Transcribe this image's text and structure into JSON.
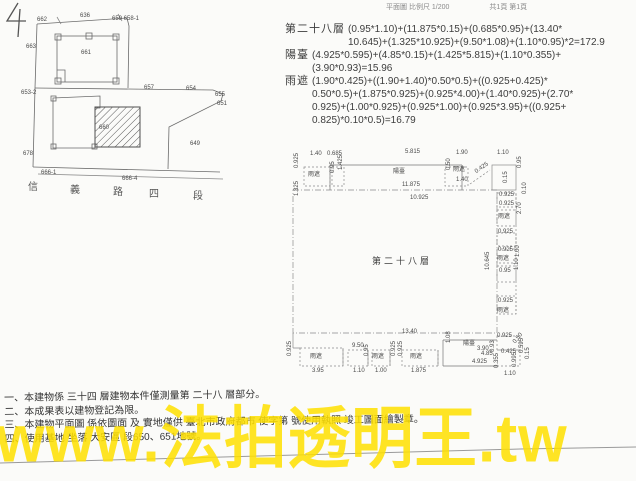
{
  "page": {
    "corner_mark": "4",
    "header": {
      "scale_text": "平面圖 比例尺  1/200",
      "page_text": "共1頁 第1頁"
    }
  },
  "calculations": {
    "entries": [
      {
        "label": "第二十八層",
        "lines": [
          "(0.95*1.10)+(11.875*0.15)+(0.685*0.95)+(13.40*",
          "10.645)+(1.325*10.925)+(9.50*1.08)+(1.10*0.95)*2=172.9"
        ]
      },
      {
        "label": "陽臺",
        "lines": [
          "(4.925*0.595)+(4.85*0.15)+(1.425*5.815)+(1.10*0.355)+",
          "(3.90*0.93)=15.96"
        ]
      },
      {
        "label": "雨遮",
        "lines": [
          "(1.90*0.425)+((1.90+1.40)*0.50*0.5)+((0.925+0.425)*",
          "0.50*0.5)+(1.875*0.925)+(0.925*4.00)+(1.40*0.925)+(2.70*",
          "0.925)+(1.00*0.925)+(0.925*1.00)+(0.925*3.95)+((0.925+",
          "0.825)*0.10*0.5)=16.79"
        ]
      }
    ]
  },
  "site_plan": {
    "hatched_parcel": "660",
    "parcels": [
      {
        "t": "662",
        "x": 37,
        "y": 17
      },
      {
        "t": "636",
        "x": 80,
        "y": 13
      },
      {
        "t": "659 658-1",
        "x": 112,
        "y": 16
      },
      {
        "t": "663",
        "x": 26,
        "y": 44
      },
      {
        "t": "661",
        "x": 81,
        "y": 50
      },
      {
        "t": "653-2",
        "x": 21,
        "y": 90
      },
      {
        "t": "657",
        "x": 144,
        "y": 85
      },
      {
        "t": "654",
        "x": 186,
        "y": 86
      },
      {
        "t": "655",
        "x": 215,
        "y": 92
      },
      {
        "t": "651",
        "x": 217,
        "y": 101
      },
      {
        "t": "660",
        "x": 99,
        "y": 125
      },
      {
        "t": "649",
        "x": 190,
        "y": 141
      },
      {
        "t": "678",
        "x": 23,
        "y": 151
      },
      {
        "t": "666-1",
        "x": 41,
        "y": 170
      },
      {
        "t": "666-4",
        "x": 122,
        "y": 176
      }
    ],
    "street": [
      {
        "t": "信",
        "x": 28,
        "y": 185,
        "cls": "street"
      },
      {
        "t": "義",
        "x": 70,
        "y": 188,
        "cls": "street"
      },
      {
        "t": "路",
        "x": 113,
        "y": 190,
        "cls": "street"
      },
      {
        "t": "四",
        "x": 149,
        "y": 192,
        "cls": "street"
      },
      {
        "t": "段",
        "x": 193,
        "y": 194,
        "cls": "street"
      }
    ]
  },
  "floor_plan": {
    "room_label": "第二十八層",
    "labels": [
      {
        "t": "1.40",
        "x": 310,
        "y": 151
      },
      {
        "t": "0.685",
        "x": 327,
        "y": 151
      },
      {
        "t": "0.925",
        "x": 294,
        "y": 168,
        "rot": -90
      },
      {
        "t": "雨遮",
        "x": 308,
        "y": 172
      },
      {
        "t": "0.95",
        "x": 330,
        "y": 173,
        "rot": -90
      },
      {
        "t": "1.425",
        "x": 338,
        "y": 170,
        "rot": -90
      },
      {
        "t": "1.325",
        "x": 294,
        "y": 196,
        "rot": -90
      },
      {
        "t": "5.815",
        "x": 405,
        "y": 149
      },
      {
        "t": "陽臺",
        "x": 393,
        "y": 169
      },
      {
        "t": "11.875",
        "x": 402,
        "y": 182
      },
      {
        "t": "1.90",
        "x": 456,
        "y": 150
      },
      {
        "t": "0.50",
        "x": 446,
        "y": 170,
        "rot": -90
      },
      {
        "t": "雨遮",
        "x": 453,
        "y": 167
      },
      {
        "t": "1.40",
        "x": 456,
        "y": 177
      },
      {
        "t": "0.425",
        "x": 474,
        "y": 170,
        "rot": -35
      },
      {
        "t": "1.10",
        "x": 497,
        "y": 150
      },
      {
        "t": "0.95",
        "x": 517,
        "y": 168,
        "rot": -90
      },
      {
        "t": "0.15",
        "x": 503,
        "y": 183,
        "rot": -90
      },
      {
        "t": "10.925",
        "x": 410,
        "y": 195
      },
      {
        "t": "0.925",
        "x": 499,
        "y": 192
      },
      {
        "t": "0.10",
        "x": 522,
        "y": 194,
        "rot": -90
      },
      {
        "t": "0.925",
        "x": 499,
        "y": 201
      },
      {
        "t": "雨遮",
        "x": 498,
        "y": 214
      },
      {
        "t": "2.70",
        "x": 517,
        "y": 214,
        "rot": -90
      },
      {
        "t": "0.925",
        "x": 498,
        "y": 229
      },
      {
        "t": "0.925",
        "x": 498,
        "y": 247
      },
      {
        "t": "雨遮",
        "x": 497,
        "y": 256
      },
      {
        "t": "1.00",
        "x": 515,
        "y": 257,
        "rot": -90
      },
      {
        "t": "10.645",
        "x": 485,
        "y": 270,
        "rot": -90
      },
      {
        "t": "0.95",
        "x": 499,
        "y": 268
      },
      {
        "t": "1.10",
        "x": 514,
        "y": 270,
        "rot": -90
      },
      {
        "t": "0.925",
        "x": 498,
        "y": 298
      },
      {
        "t": "雨遮",
        "x": 497,
        "y": 308
      },
      {
        "t": "13.40",
        "x": 402,
        "y": 329
      },
      {
        "t": "0.925",
        "x": 287,
        "y": 356,
        "rot": -90
      },
      {
        "t": "雨遮",
        "x": 310,
        "y": 354
      },
      {
        "t": "3.95",
        "x": 312,
        "y": 368
      },
      {
        "t": "9.50",
        "x": 352,
        "y": 343
      },
      {
        "t": "1.10",
        "x": 353,
        "y": 368
      },
      {
        "t": "0.95",
        "x": 364,
        "y": 356,
        "rot": -90
      },
      {
        "t": "雨遮",
        "x": 372,
        "y": 354
      },
      {
        "t": "1.00",
        "x": 375,
        "y": 368
      },
      {
        "t": "0.925",
        "x": 391,
        "y": 356,
        "rot": -90
      },
      {
        "t": "0.925",
        "x": 398,
        "y": 356,
        "rot": -90
      },
      {
        "t": "雨遮",
        "x": 410,
        "y": 354
      },
      {
        "t": "1.875",
        "x": 411,
        "y": 368
      },
      {
        "t": "1.08",
        "x": 446,
        "y": 343,
        "rot": -90
      },
      {
        "t": "陽臺",
        "x": 463,
        "y": 341
      },
      {
        "t": "3.90",
        "x": 477,
        "y": 346
      },
      {
        "t": "4.85",
        "x": 481,
        "y": 351
      },
      {
        "t": "4.925",
        "x": 472,
        "y": 359
      },
      {
        "t": "0.925",
        "x": 497,
        "y": 333
      },
      {
        "t": "0.50",
        "x": 512,
        "y": 341,
        "rot": -50
      },
      {
        "t": "0.93",
        "x": 490,
        "y": 352,
        "rot": -90
      },
      {
        "t": "0.425",
        "x": 501,
        "y": 349
      },
      {
        "t": "0.595",
        "x": 519,
        "y": 353,
        "rot": -90
      },
      {
        "t": "0.15",
        "x": 525,
        "y": 359,
        "rot": -90
      },
      {
        "t": "0.355",
        "x": 494,
        "y": 368,
        "rot": -90
      },
      {
        "t": "1.10",
        "x": 504,
        "y": 371
      },
      {
        "t": "0.995",
        "x": 512,
        "y": 367,
        "rot": -90
      }
    ]
  },
  "notes": {
    "lines": [
      "一、本建物係 三十四 層建物本件僅測量第 二十八 層部分。",
      "二、本成果表以建物登記為限。",
      "三、本建物平面圖 係依圖面 及 實地僅供 臺北市政府都市 使字第 號使用執照 竣工圖面繪製章。",
      "四、使用基地 坐落 大安區 段650、651地號。"
    ]
  },
  "watermark": {
    "text": "www.法拍透明王.tw",
    "color": "#ffe000"
  }
}
